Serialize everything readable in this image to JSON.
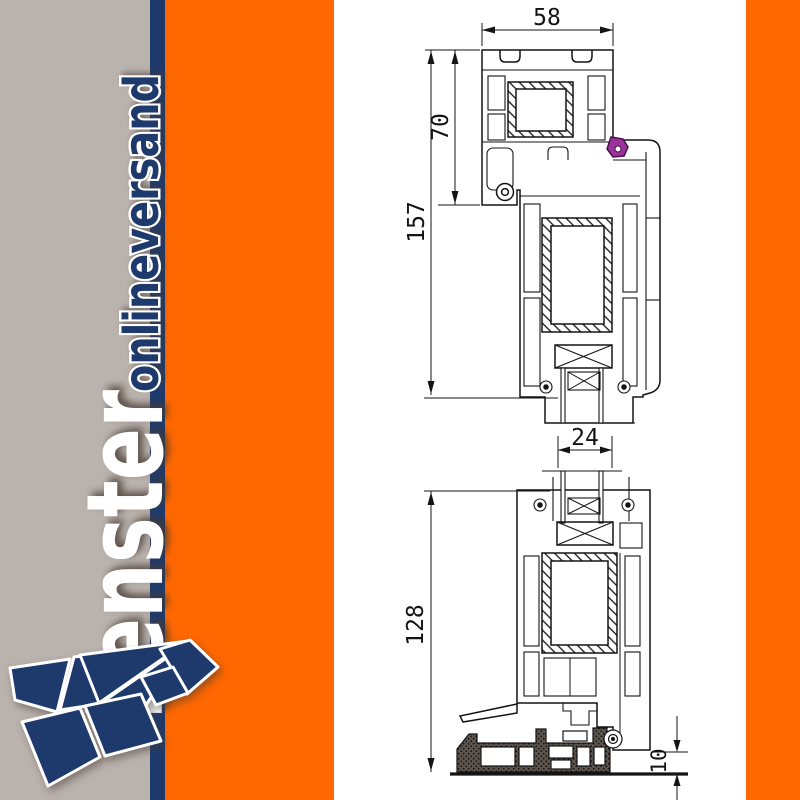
{
  "page": {
    "type": "product-image",
    "description": "Technical cross-section drawing of a PVC window profile (frame, sash, glazing and sill)"
  },
  "brand": {
    "name_main": "Fenster",
    "name_sub": "onlineversand"
  },
  "palette": {
    "gray_band": "#bab2ad",
    "navy": "#1e3a6d",
    "orange": "#ff6700",
    "drawing_line": "#141414",
    "gasket_purple": "#993399",
    "sill_fill": "#4e4843"
  },
  "dimensions": {
    "frame_face_width_mm": "58",
    "frame_height_mm": "70",
    "top_section_total_mm": "157",
    "glazing_thickness_mm": "24",
    "bottom_section_total_mm": "128",
    "sill_edge_mm": "10"
  }
}
